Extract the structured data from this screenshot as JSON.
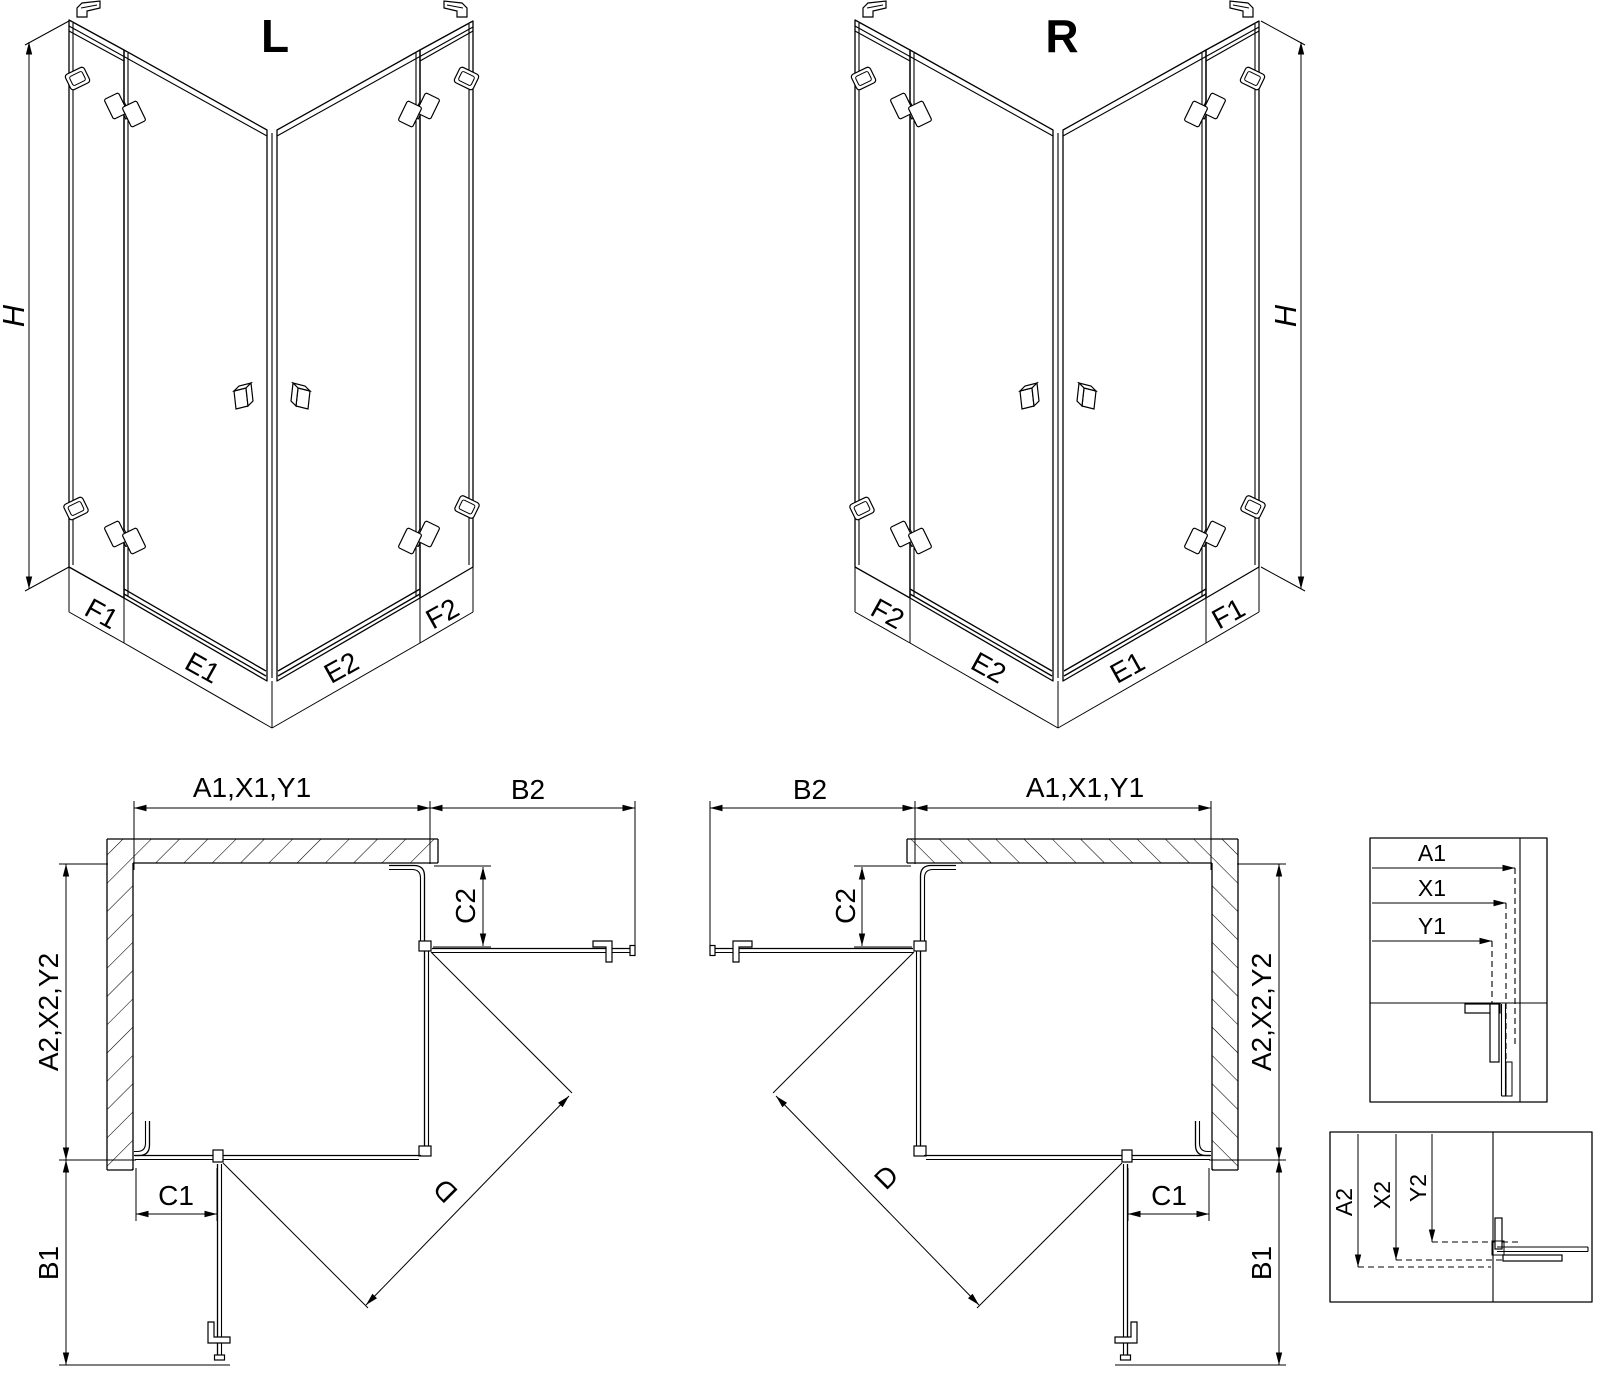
{
  "drawing": {
    "iso_left": {
      "title": "L",
      "height_label": "H",
      "bands": [
        "F1",
        "E1",
        "E2",
        "F2"
      ]
    },
    "iso_right": {
      "title": "R",
      "height_label": "H",
      "bands": [
        "F2",
        "E2",
        "E1",
        "F1"
      ]
    },
    "plan_left": {
      "width": "A1,X1,Y1",
      "open_top": "B2",
      "depth": "A2,X2,Y2",
      "open_side": "B1",
      "fixed_top": "C2",
      "fixed_side": "C1",
      "diagonal": "D"
    },
    "plan_right": {
      "width": "A1,X1,Y1",
      "open_top": "B2",
      "depth": "A2,X2,Y2",
      "open_side": "B1",
      "fixed_top": "C2",
      "fixed_side": "C1",
      "diagonal": "D"
    },
    "detail_width": {
      "labels": [
        "A1",
        "X1",
        "Y1"
      ]
    },
    "detail_depth": {
      "labels": [
        "A2",
        "X2",
        "Y2"
      ]
    }
  }
}
